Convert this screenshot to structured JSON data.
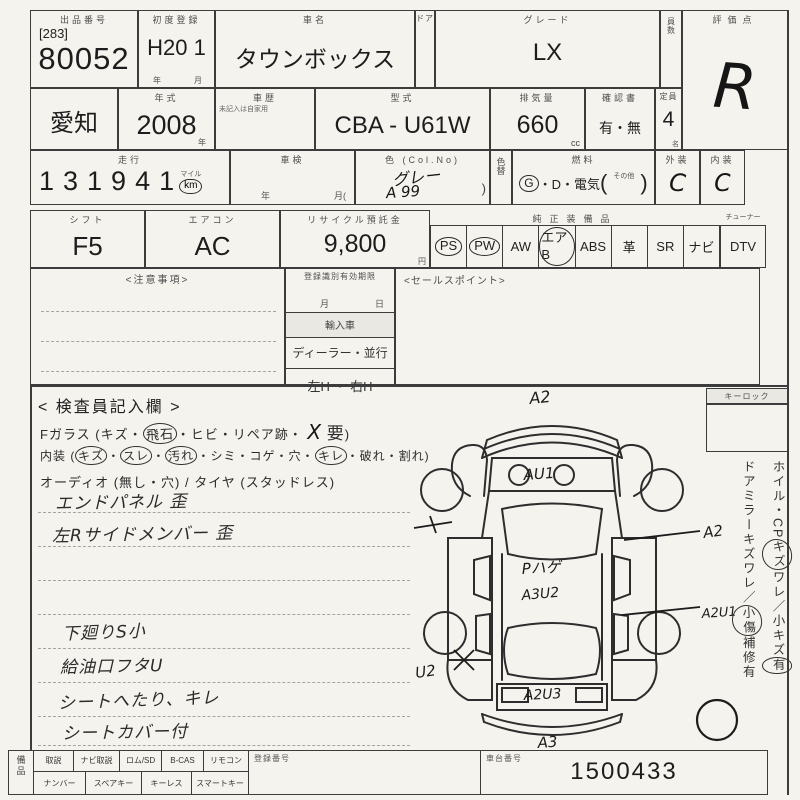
{
  "r1": {
    "lot_label": "出品番号",
    "lot_bracket": "[283]",
    "lot_number": "80052",
    "firstreg_label": "初度登録",
    "firstreg_value": "H20 1",
    "firstreg_year": "年",
    "firstreg_month": "月",
    "carname_label": "車名",
    "carname_value": "タウンボックス",
    "door_label": "ドア",
    "grade_label": "グレード",
    "grade_value": "LX",
    "qty_label": "員数",
    "score_label": "評価点",
    "score_value": "R"
  },
  "r2": {
    "prefecture": "愛知",
    "year_label": "年式",
    "year_value": "2008",
    "year_unit": "年",
    "history_label": "車歴",
    "history_note": "未記入は自家用",
    "model_label": "型式",
    "model_value": "CBA - U61W",
    "disp_label": "排気量",
    "disp_value": "660",
    "disp_unit": "cc",
    "docs_label": "確認書",
    "docs_value": "有・無",
    "cap_label": "定員",
    "cap_value": "4",
    "cap_unit": "名"
  },
  "r3": {
    "mileage_label": "走行",
    "mileage_value": "131941",
    "unit_mile": "マイル",
    "unit_km": "km",
    "shaken_label": "車検",
    "shaken_year": "年",
    "shaken_month": "月(",
    "color_label": "色 (Col.No)",
    "color_value": "グレー",
    "color_code": "A 99",
    "color_close": ")",
    "colorchg_label": "色替",
    "fuel_label": "燃料",
    "fuel_g": "G",
    "fuel_rest": "・D・電気",
    "fuel_open": "(",
    "fuel_other": "その他",
    "fuel_close": ")",
    "ext_label": "外装",
    "ext_value": "C",
    "int_label": "内装",
    "int_value": "C"
  },
  "r4": {
    "shift_label": "シフト",
    "shift_value": "F5",
    "ac_label": "エアコン",
    "ac_value": "AC",
    "rec_label": "リサイクル預託金",
    "rec_value": "9,800",
    "rec_unit": "円",
    "equip_label": "純正装備品",
    "equip_items": [
      "PS",
      "PW",
      "AW",
      "エアB",
      "ABS",
      "革",
      "SR",
      "ナビ"
    ],
    "tuner_label": "チューナー",
    "tuner_value": "DTV"
  },
  "mid": {
    "notes_label": "<注意事項>",
    "reg_header": "登録識別有効期限",
    "reg_month": "月",
    "reg_day": "日",
    "import_label": "輸入車",
    "dealer_label": "ディーラー・並行",
    "handle_label": "左H ・ 右H",
    "sales_label": "<セールスポイント>"
  },
  "insp": {
    "title": "< 検査員記入欄 >",
    "sep": "・",
    "glass_prefix": "Fガラス (",
    "glass": [
      {
        "t": "キズ"
      },
      {
        "t": "飛石"
      },
      {
        "t": "ヒビ"
      },
      {
        "t": "リペア跡"
      }
    ],
    "glass_hand": "X",
    "glass_req": "要",
    "glass_close": ")",
    "interior_prefix": "内装 (",
    "interior": [
      {
        "t": "キズ"
      },
      {
        "t": "スレ"
      },
      {
        "t": "汚れ"
      },
      {
        "t": "シミ"
      },
      {
        "t": "コゲ"
      },
      {
        "t": "穴"
      },
      {
        "t": "キレ"
      },
      {
        "t": "破れ"
      },
      {
        "t": "割れ"
      }
    ],
    "interior_close": ")",
    "audio_line": "オーディオ (無し・穴) / タイヤ (スタッドレス)",
    "notes1": [
      "エンドパネル 歪",
      "左Rサイドメンバー 歪"
    ],
    "notes2": [
      "下廻りS小",
      "給油口フタU",
      "シートへたり、キレ",
      "シートカバー付"
    ]
  },
  "diag": {
    "front": "A2",
    "hood": "AU1",
    "right_front": "A2",
    "roof_paint": "Pハゲ",
    "roof": "A3U2",
    "right_rear": "A2U1",
    "left_rear": "U2",
    "rear": "A2U3",
    "rear_bumper": "A3"
  },
  "right": {
    "keylock_label": "キーロック",
    "s1a": "ホイル・CP",
    "s1c": "キズ",
    "s1b": "ワレ／小キズ",
    "s1d": "有",
    "s2a": "ドアミラー",
    "s2c": "キズ",
    "s2b": "ワレ／",
    "s2d": "小傷",
    "s2e": "補修有"
  },
  "bottom": {
    "equip_label": "備品",
    "row1": [
      "取説",
      "ナビ取説",
      "ロム/SD",
      "B-CAS",
      "リモコン"
    ],
    "row2": [
      "ナンバー",
      "スペアキー",
      "キーレス",
      "スマートキー"
    ],
    "regno_label": "登録番号",
    "chassis_label": "車台番号",
    "chassis_value": "1500433"
  }
}
